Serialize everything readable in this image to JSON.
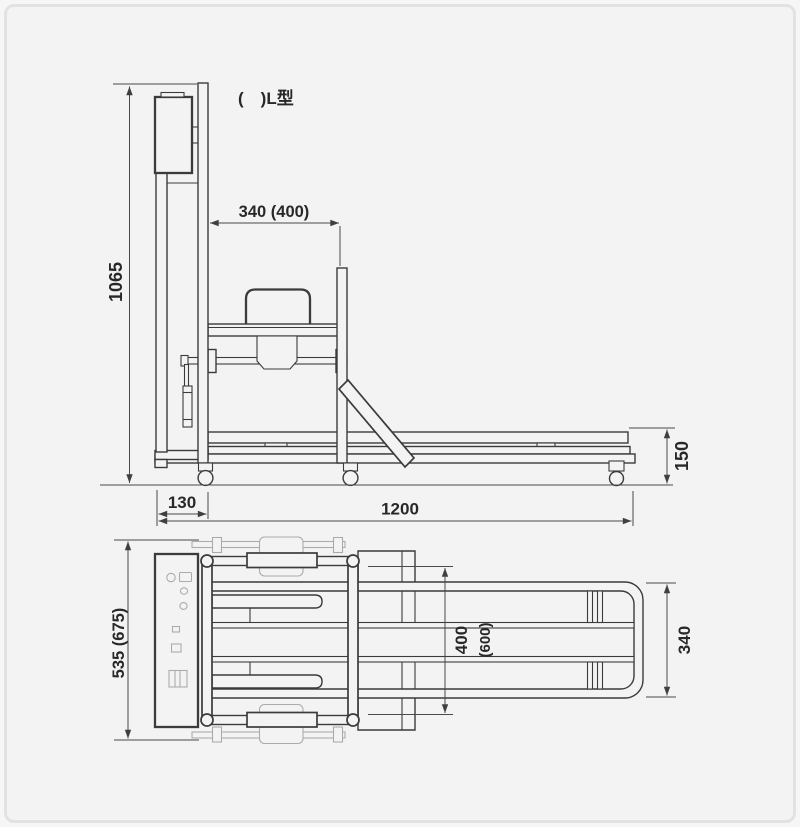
{
  "diagram": {
    "type_note": "(　)L型",
    "side_view": {
      "dims": {
        "overall_height": "1065",
        "clamp_stroke": "340 (400)",
        "mast_offset": "130",
        "overall_length": "1200",
        "deck_height": "150"
      }
    },
    "plan_view": {
      "dims": {
        "overall_width": "535 (675)",
        "inner_width": "400",
        "inner_width_alt": "(600)",
        "end_frame_width": "340"
      }
    },
    "colors": {
      "line": "#3b3b3d",
      "light_line": "#ababad",
      "dim_line": "#4a4a4c",
      "text": "#28282a",
      "background": "#f3f3f4",
      "frame_border": "#e2e2e4"
    }
  }
}
